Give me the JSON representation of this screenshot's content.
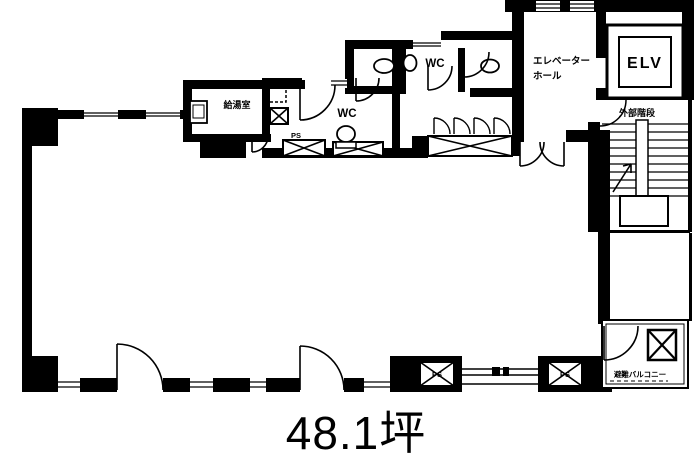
{
  "plan": {
    "title": "office-floor-plan",
    "area_label": "48.1坪",
    "labels": {
      "elevator_hall_line1": "エレベーター",
      "elevator_hall_line2": "ホール",
      "elv": "ELV",
      "external_stairs": "外部階段",
      "wc_upper": "WC",
      "wc_lower": "WC",
      "kitchenette": "給湯室",
      "ps_entry": "PS",
      "ps_bottom_left": "PS",
      "ps_bottom_right": "PS",
      "evacuation_balcony": "避難バルコニー"
    },
    "colors": {
      "ink": "#000000",
      "background": "#ffffff"
    }
  }
}
